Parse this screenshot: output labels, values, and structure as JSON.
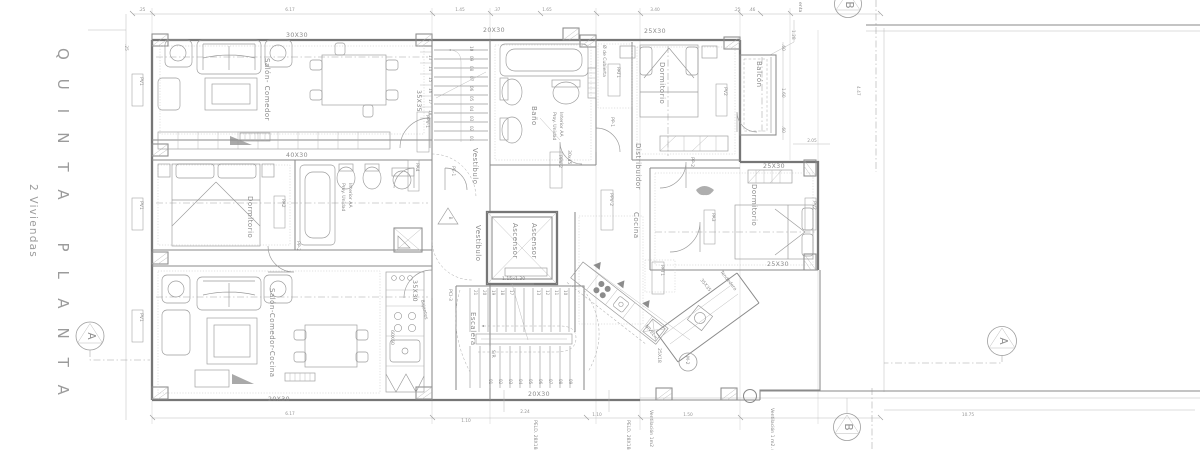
{
  "title": {
    "main": "QUINTA PLANTA",
    "sub": "2 Viviendas"
  },
  "markers": {
    "a": "A",
    "b": "B"
  },
  "rooms": {
    "salon1": "Salón- Comedor",
    "dorm": "Dormitorio",
    "salon2": "Salón-Comedor-Cocina",
    "bano": "Baño",
    "vestibulo": "Vestíbulo",
    "ascensor": "Ascensor",
    "escalera": "Escalera",
    "cocina": "Cocina",
    "distribuidor": "Distribuidor",
    "balcon": "Balcón",
    "tendedero": "Tendedero",
    "sr": "S/R"
  },
  "tiles": {
    "t3030": "30X30",
    "t2030": "20X30",
    "t2530": "25X30",
    "t4030": "40X30",
    "t3530": "35X30",
    "t3535": "35X35",
    "t2518": "25X18",
    "t3045": "30x45",
    "t6060": "60X60"
  },
  "openings": {
    "pv1": "PV1",
    "pv2": "PV2",
    "pa2": "PA2",
    "pa3": "PA3",
    "pa4": "PA4",
    "pp1": "PP-1",
    "pp2": "PP-2",
    "ppv1": "PPV-1",
    "ppv2": "PPV-2",
    "pe1": "PE-1",
    "pci3": "PCI-3",
    "pat1": "PAT1"
  },
  "annotations": {
    "proy_l1": "Proy. Unidad",
    "proy_l2": "Interior AA",
    "cubierta": "Ø de Cubierta",
    "elevator_size": "1.15x1.30",
    "peld": "PELD. 28X18c",
    "vent1": "Ventilación 1m2",
    "vent2": "Ventilación 1 m2. min.",
    "nivel": "NIVEL=",
    "m2": "M-2",
    "bajantes": "Bajantes",
    "frag": "enta"
  },
  "stairs": {
    "upper_side": [
      "13",
      "14",
      "15",
      "16",
      "17",
      "18"
    ],
    "upper_core": [
      "10",
      "09",
      "08",
      "07",
      "06",
      "05",
      "04",
      "03",
      "02",
      "01"
    ],
    "lower_top": [
      "21",
      "20",
      "19",
      "18",
      "17",
      "13",
      "12",
      "11",
      "10"
    ],
    "lower_bottom": [
      "01",
      "02",
      "03",
      "04",
      "05",
      "06",
      "07",
      "08",
      "09"
    ]
  },
  "dims": {
    "d25": ".25",
    "d617": "6.17",
    "d145": "1.45",
    "d37": ".37",
    "d165": "1.65",
    "d340": "3.40",
    "d46": ".46",
    "d128": "1.28",
    "d205": "2.05",
    "d60": ".60",
    "d160": "1.60",
    "d447": "4.47",
    "d224": "2.24",
    "d110": "1.10",
    "d150": "1.50",
    "d1075": "10.75"
  }
}
